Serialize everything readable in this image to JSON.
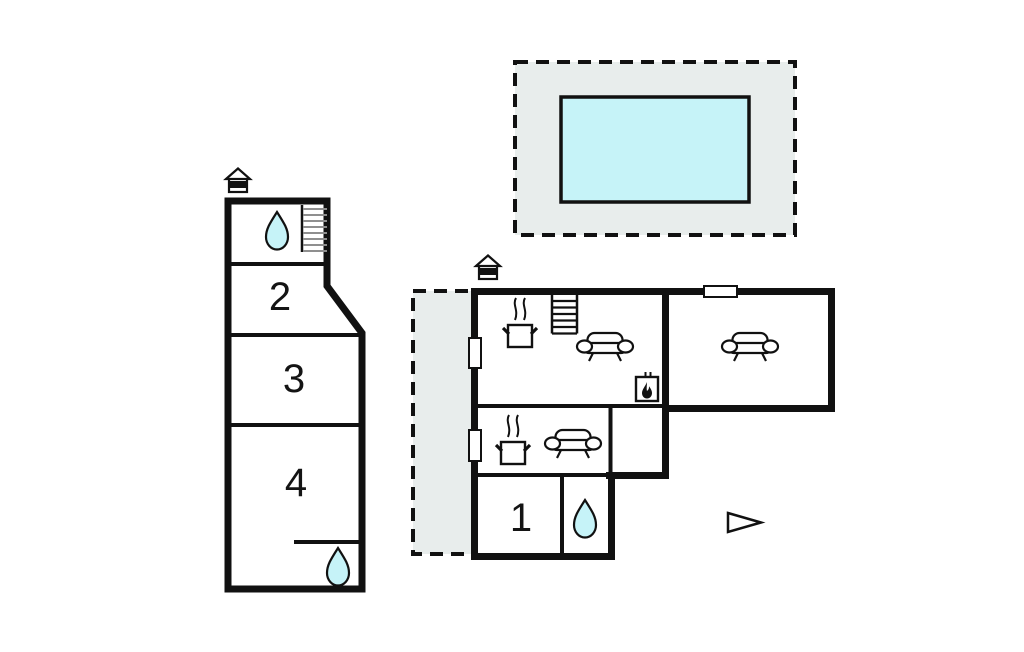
{
  "diagram": {
    "type": "floor-plan",
    "rooms": {
      "room1": {
        "label": "1"
      },
      "room2": {
        "label": "2"
      },
      "room3": {
        "label": "3"
      },
      "room4": {
        "label": "4"
      }
    },
    "icons": {
      "entrance": "entrance-icon",
      "water_drop": "water-drop-icon",
      "stairs": "stairs-icon",
      "sofa": "sofa-icon",
      "stove": "stove-icon",
      "fireplace": "fireplace-icon",
      "north_arrow": "north-arrow-icon"
    },
    "colors": {
      "wall": "#111111",
      "water_fill": "#c6f3f8",
      "deck_fill": "#e8edec",
      "background": "#ffffff"
    }
  }
}
